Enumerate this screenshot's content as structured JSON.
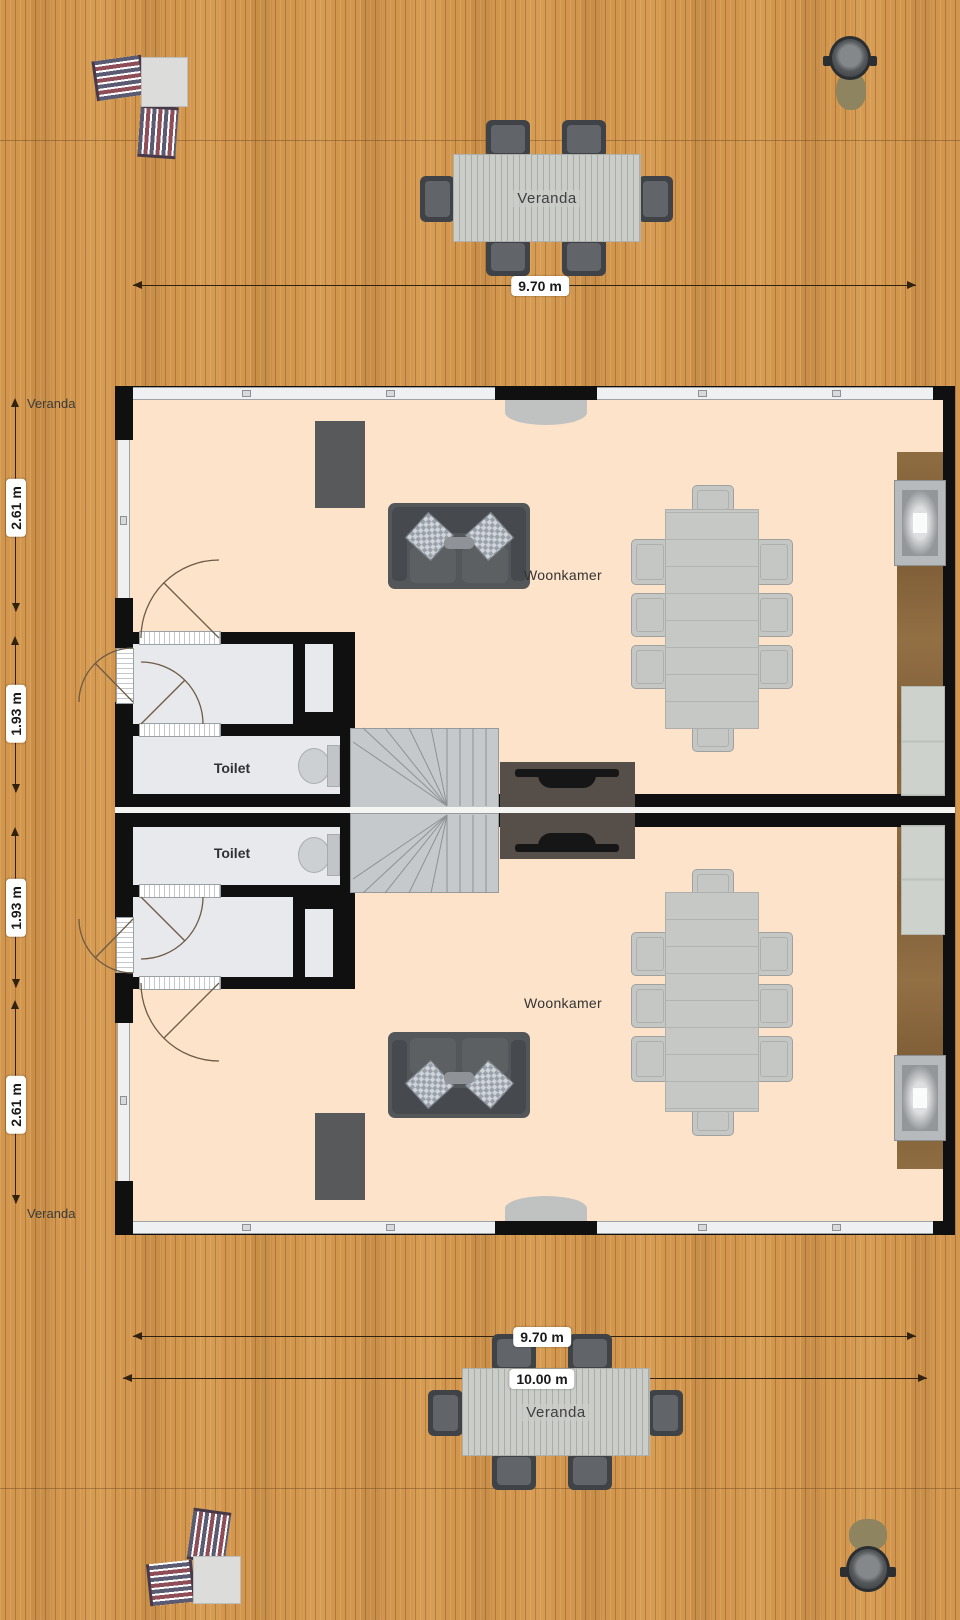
{
  "plan": {
    "dimensions": {
      "top_width": "9.70 m",
      "bottom_width": "9.70 m",
      "bottom_total_width": "10.00 m",
      "upper_living_depth": "2.61 m",
      "upper_entry_depth": "1.93 m",
      "lower_entry_depth": "1.93 m",
      "lower_living_depth": "2.61 m"
    },
    "side_labels": {
      "veranda_top": "Veranda",
      "veranda_bottom": "Veranda"
    },
    "outdoor": {
      "table_top_label": "Veranda",
      "table_bottom_label": "Veranda"
    },
    "units": {
      "upper": {
        "living_room": "Woonkamer",
        "toilet": "Toilet"
      },
      "lower": {
        "living_room": "Woonkamer",
        "toilet": "Toilet"
      }
    },
    "colors": {
      "deck_wood": "#d2964e",
      "floor": "#fce3c9",
      "walls": "#101010",
      "interior_rooms": "#e7e9ed",
      "stairs": "#c6c9cc",
      "kitchen_counter": "#8a6a40",
      "sofa": "#53575a",
      "dining_furniture": "#c6c8c5",
      "outdoor_chairs": "#3f4347"
    }
  }
}
